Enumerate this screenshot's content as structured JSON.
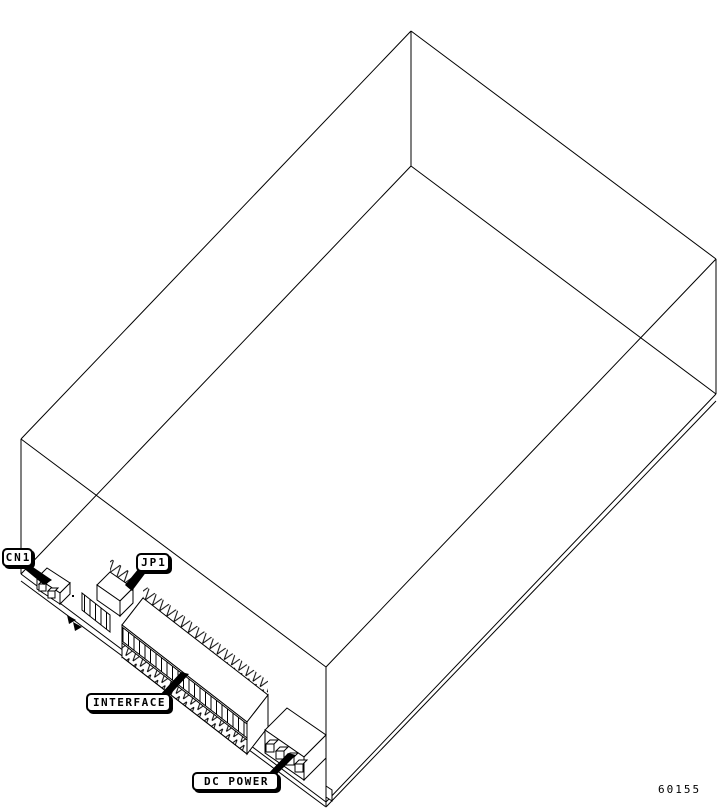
{
  "figure": {
    "background": "#ffffff",
    "line_color": "#000000",
    "code": "60155",
    "callouts": [
      {
        "id": "cn1",
        "label": "CN1"
      },
      {
        "id": "jp1",
        "label": "JP1"
      },
      {
        "id": "interface",
        "label": "INTERFACE"
      },
      {
        "id": "dc-power",
        "label": "DC POWER"
      }
    ]
  }
}
